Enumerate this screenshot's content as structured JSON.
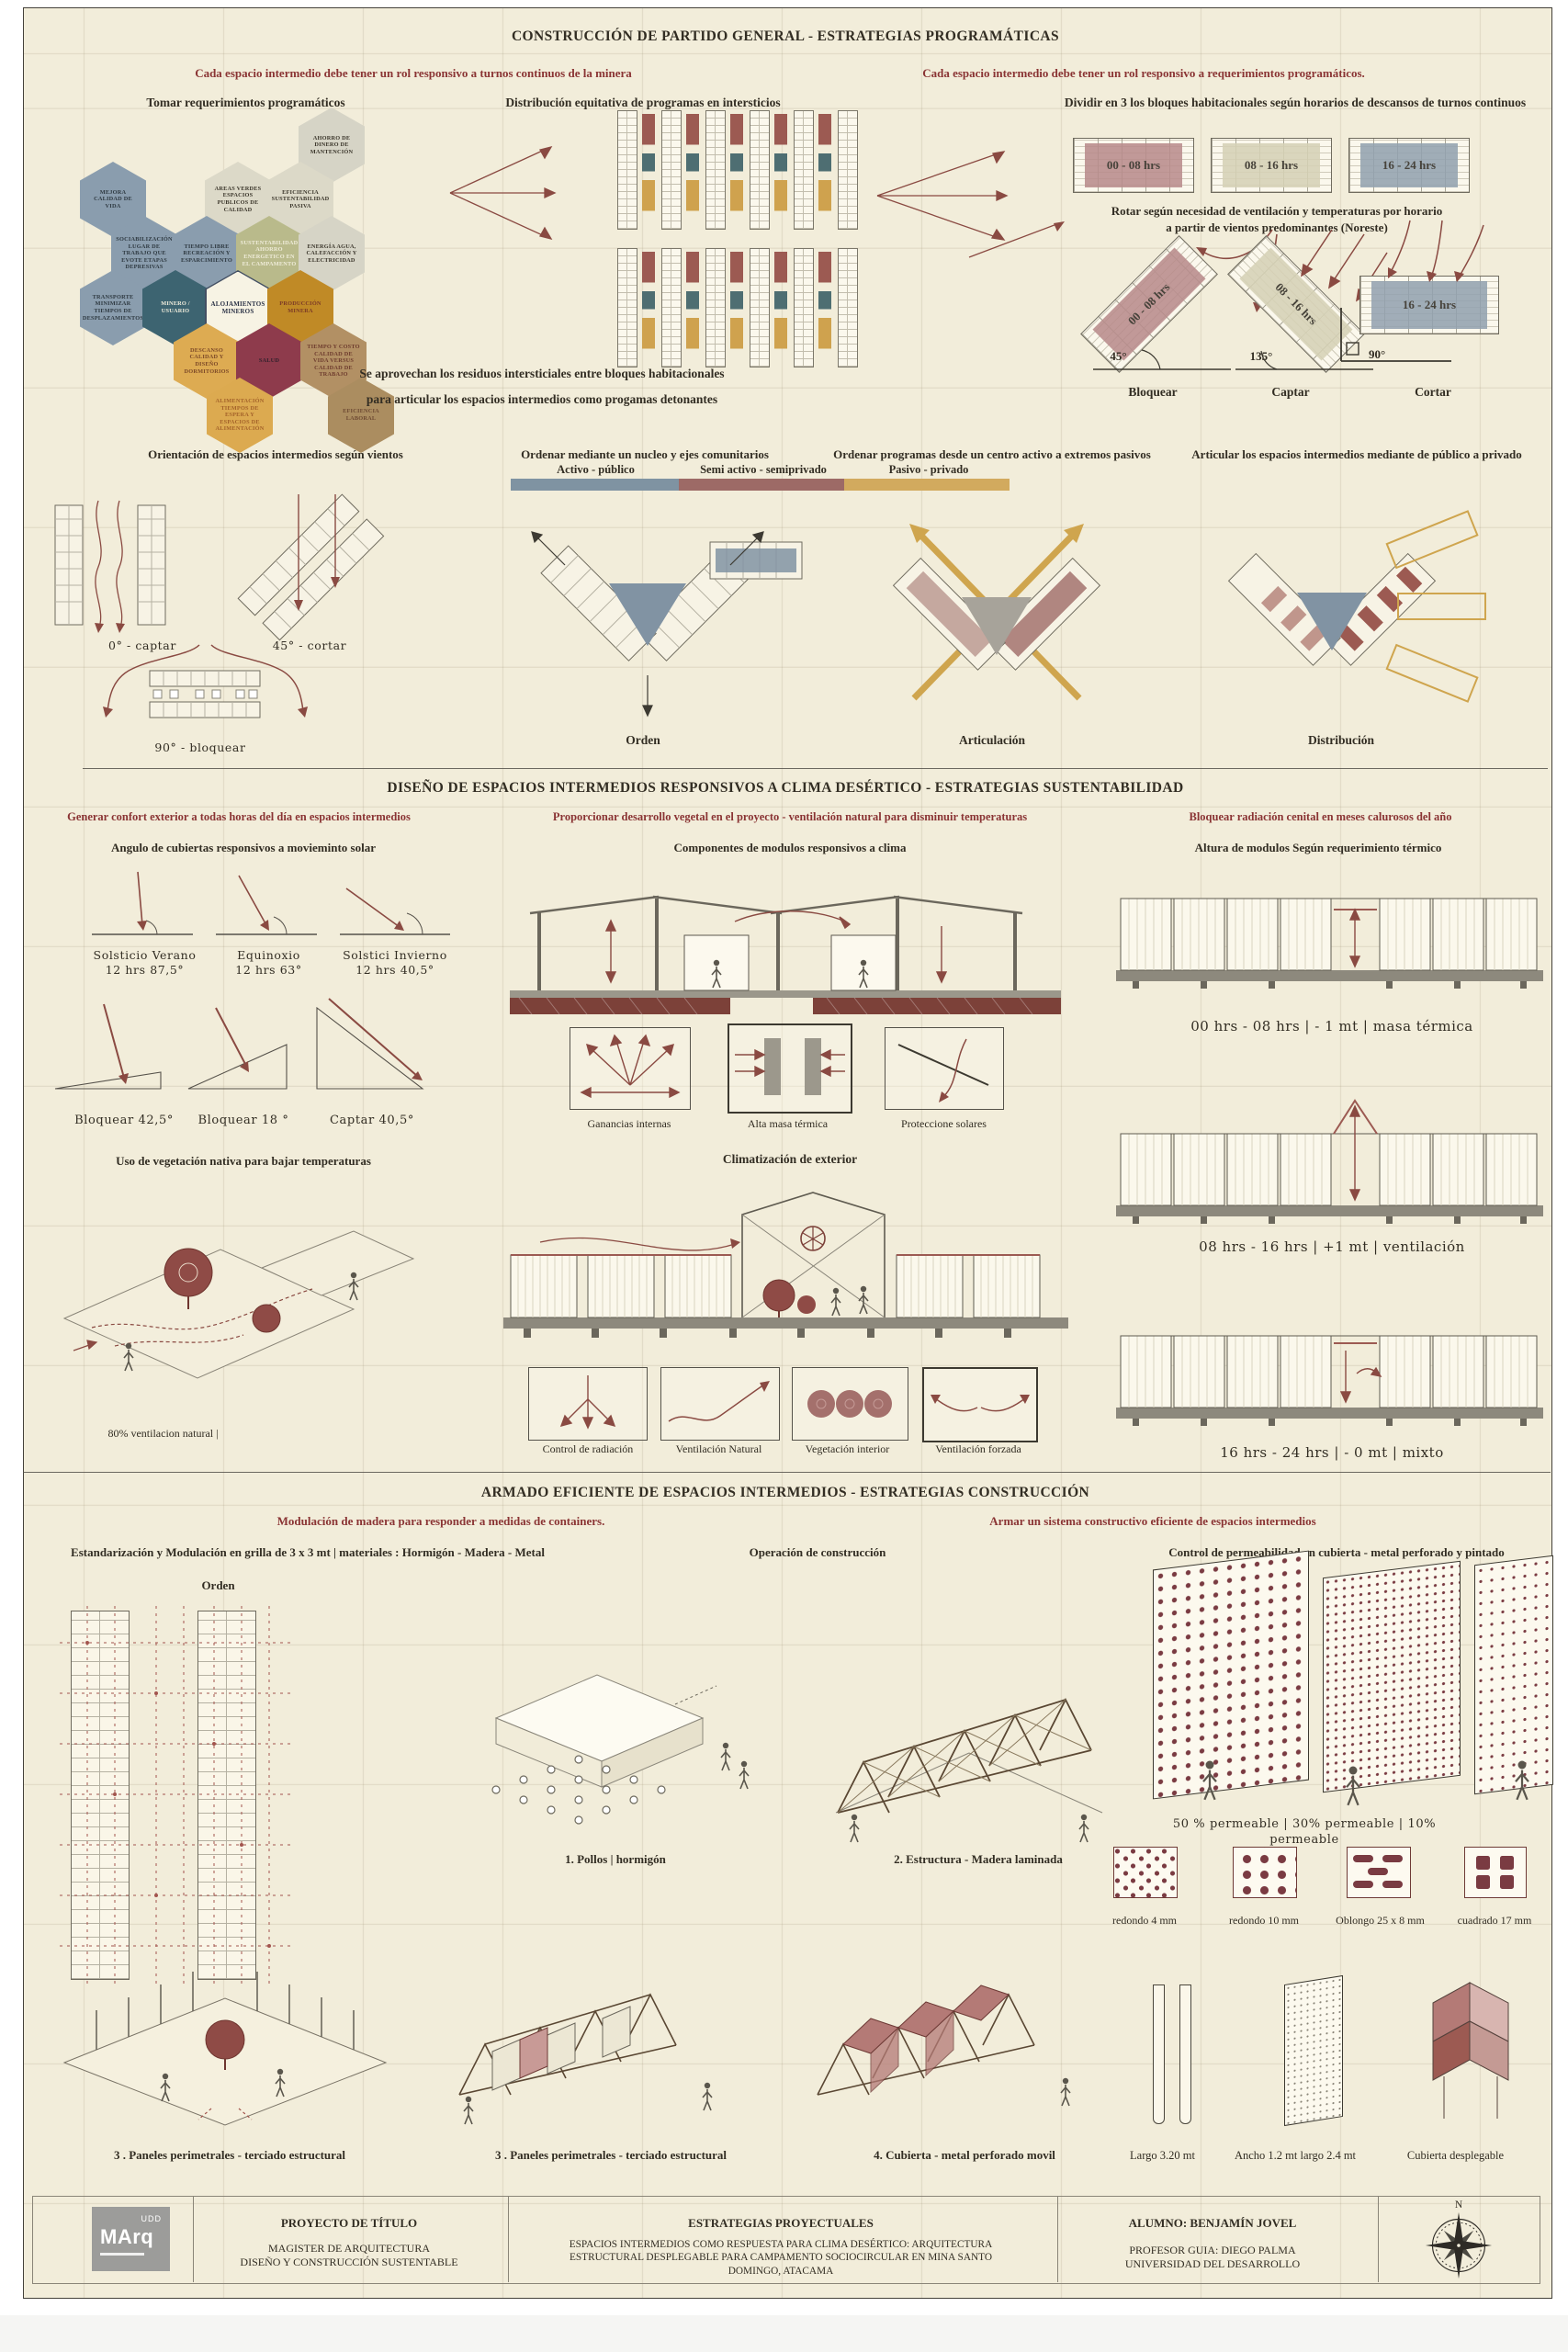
{
  "s1": {
    "title": "CONSTRUCCIÓN DE PARTIDO GENERAL - ESTRATEGIAS PROGRAMÁTICAS",
    "note_left": "Cada espacio intermedio debe tener un rol responsivo a turnos continuos de la minera",
    "note_right": "Cada espacio intermedio debe tener un rol responsivo a requerimientos programáticos.",
    "hex_title": "Tomar requerimientos programáticos",
    "hexagons": [
      {
        "label": "AHORRO DE DINERO DE MANTENCIÓN",
        "bg": "#d6d4c6",
        "fg": "#3b362b"
      },
      {
        "label": "MEJORA CALIDAD DE VIDA",
        "bg": "#8a9dae",
        "fg": "#2f3a42"
      },
      {
        "label": "AREAS VERDES ESPACIOS PUBLICOS DE CALIDAD",
        "bg": "#dcd9c8",
        "fg": "#3b362b"
      },
      {
        "label": "EFICIENCIA SUSTENTABILIDAD PASIVA",
        "bg": "#dcd9c8",
        "fg": "#3b362b"
      },
      {
        "label": "SOCIABILIZACIÓN LUGAR DE TRABAJO QUE EVOTE ETAPAS DEPRESIVAS",
        "bg": "#8a9dae",
        "fg": "#2f3a42"
      },
      {
        "label": "TIEMPO LIBRE RECREACIÓN Y ESPARCIMIENTO",
        "bg": "#8a9dae",
        "fg": "#2f3a42"
      },
      {
        "label": "SUSTENTABILIDAD AHORRO ENERGETICO EN EL CAMPAMENTO",
        "bg": "#b9ba8b",
        "fg": "#efecd9"
      },
      {
        "label": "ENERGÍA AGUA, CALEFACCIÓN Y ELECTRICIDAD",
        "bg": "#d6d4c6",
        "fg": "#3b362b"
      },
      {
        "label": "TRANSPORTE MINIMIZAR TIEMPOS DE DESPLAZAMIENTOS",
        "bg": "#8a9dae",
        "fg": "#2f3a42"
      },
      {
        "label": "MINERO / USUARIO",
        "bg": "#3d6471",
        "fg": "#f2eedd"
      },
      {
        "label": "ALOJAMIENTOS MINEROS",
        "bg": "#f7f3e4",
        "fg": "#2c3347",
        "border": "#434f63"
      },
      {
        "label": "PRODUCCIÓN MINERA",
        "bg": "#c08a26",
        "fg": "#7b3a26"
      },
      {
        "label": "DESCANSO CALIDAD Y DISEÑO DORMITORIOS",
        "bg": "#ddab52",
        "fg": "#7d4a28"
      },
      {
        "label": "SALUD",
        "bg": "#8e3b4c",
        "fg": "#31202c"
      },
      {
        "label": "TIEMPO Y COSTO CALIDAD DE VIDA VERSUS CALIDAD DE TRABAJO",
        "bg": "#b29064",
        "fg": "#6e3c2e"
      },
      {
        "label": "ALIMENTACIÓN TIEMPOS DE ESPERA Y ESPACIOS DE ALIMENTACIÓN",
        "bg": "#dcaa50",
        "fg": "#a4632a"
      },
      {
        "label": "EFICIENCIA LABORAL",
        "bg": "#ab8d60",
        "fg": "#6e4a33"
      }
    ],
    "dist_title": "Distribución equitativa de programas en intersticios",
    "divide_title": "Dividir en 3 los bloques habitacionales según horarios de descansos de turnos continuos",
    "shifts": [
      {
        "label": "00 - 08 hrs",
        "color": "#b98c8c"
      },
      {
        "label": "08 - 16 hrs",
        "color": "#d6d2b6"
      },
      {
        "label": "16 - 24 hrs",
        "color": "#93a2b0"
      }
    ],
    "rotate_note_1": "Rotar según necesidad de ventilación y temperaturas por horario",
    "rotate_note_2": "a partir de vientos predominantes (Noreste)",
    "rotations": [
      {
        "angle": "45°",
        "action": "Bloquear"
      },
      {
        "angle": "135°",
        "action": "Captar"
      },
      {
        "angle": "90°",
        "action": "Cortar"
      }
    ],
    "residuos_1": "Se aprovechan los residuos intersticiales entre bloques habitacionales",
    "residuos_2": "para articular los espacios intermedios como progamas detonantes",
    "row2_headers": [
      "Orientación de espacios intermedios según vientos",
      "Ordenar mediante un nucleo y ejes comunitarios",
      "Ordenar programas desde un centro activo a extremos pasivos",
      "Articular los espacios intermedios mediante de público a privado"
    ],
    "legend": [
      {
        "label": "Activo - público",
        "color": "#7f93a2"
      },
      {
        "label": "Semi activo - semiprivado",
        "color": "#9d6a66"
      },
      {
        "label": "Pasivo - privado",
        "color": "#d2aa5e"
      }
    ],
    "wind_labels": [
      "0° - captar",
      "45° - cortar",
      "90° - bloquear"
    ],
    "strategy_labels": [
      "Orden",
      "Articulación",
      "Distribución"
    ]
  },
  "s2": {
    "title": "DISEÑO DE ESPACIOS INTERMEDIOS RESPONSIVOS A CLIMA DESÉRTICO - ESTRATEGIAS SUSTENTABILIDAD",
    "notes": [
      "Generar confort exterior a todas horas del día en espacios intermedios",
      "Proporcionar desarrollo vegetal en el proyecto - ventilación natural para disminuir temperaturas",
      "Bloquear radiación cenital en meses calurosos del año"
    ],
    "headers": [
      "Angulo de cubiertas responsivos a movieminto solar",
      "Componentes de modulos responsivos a clima",
      "Altura de modulos Según requerimiento térmico"
    ],
    "sun": [
      {
        "name": "Solsticio Verano",
        "value": "12 hrs 87,5°"
      },
      {
        "name": "Equinoxio",
        "value": "12 hrs 63°"
      },
      {
        "name": "Solstici Invierno",
        "value": "12 hrs 40,5°"
      }
    ],
    "roof_labels": [
      "Bloquear 42,5°",
      "Bloquear 18 °",
      "Captar 40,5°"
    ],
    "veg_title": "Uso de vegetación nativa para bajar temperaturas",
    "veg_note": "80% ventilacion natural |",
    "component_labels": [
      "Ganancias internas",
      "Alta masa térmica",
      "Proteccione solares"
    ],
    "clim_title": "Climatización de exterior",
    "clim_labels": [
      "Control de radiación",
      "Ventilación Natural",
      "Vegetación interior",
      "Ventilación forzada"
    ],
    "height_labels": [
      "00 hrs - 08 hrs | - 1 mt | masa térmica",
      "08 hrs - 16 hrs | +1 mt | ventilación",
      "16 hrs - 24 hrs | - 0 mt | mixto"
    ]
  },
  "s3": {
    "title": "ARMADO EFICIENTE DE ESPACIOS INTERMEDIOS  - ESTRATEGIAS CONSTRUCCIÓN",
    "note_left": "Modulación de madera para responder a medidas de containers.",
    "note_right": "Armar un sistema constructivo eficiente de espacios intermedios",
    "headers": [
      "Estandarización y Modulación en grilla de 3 x 3 mt | materiales : Hormigón - Madera - Metal",
      "Operación de construcción",
      "Control de permeabilidad en cubierta  - metal perforado y pintado"
    ],
    "orden_label": "Orden",
    "steps": [
      "1. Pollos | hormigón",
      "2. Estructura - Madera laminada",
      "3 . Paneles perimetrales - terciado estructural",
      "3 . Paneles perimetrales - terciado estructural",
      "4. Cubierta - metal perforado movil"
    ],
    "perm_note": "50 % permeable | 30% permeable | 10% permeable",
    "perf_labels": [
      "redondo 4 mm",
      "redondo 10 mm",
      "Oblongo 25 x 8 mm",
      "cuadrado 17 mm"
    ],
    "dim_labels": [
      "Largo 3.20 mt",
      "Ancho 1.2 mt largo 2.4 mt",
      "Cubierta desplegable"
    ]
  },
  "footer": {
    "logo_main": "MArq",
    "logo_sub": "UDD",
    "col1_title": "PROYECTO DE TÍTULO",
    "col1_text": "MAGISTER DE ARQUITECTURA\nDISEÑO Y CONSTRUCCIÓN SUSTENTABLE",
    "col2_title": "ESTRATEGIAS PROYECTUALES",
    "col2_text": "ESPACIOS INTERMEDIOS COMO RESPUESTA PARA CLIMA DESÉRTICO: ARQUITECTURA\nESTRUCTURAL DESPLEGABLE PARA CAMPAMENTO SOCIOCIRCULAR EN MINA SANTO\nDOMINGO, ATACAMA",
    "col3_title": "ALUMNO: BENJAMÍN JOVEL",
    "col3_text": "PROFESOR GUIA: DIEGO PALMA\nUNIVERSIDAD DEL DESARROLLO",
    "compass_n": "N"
  }
}
